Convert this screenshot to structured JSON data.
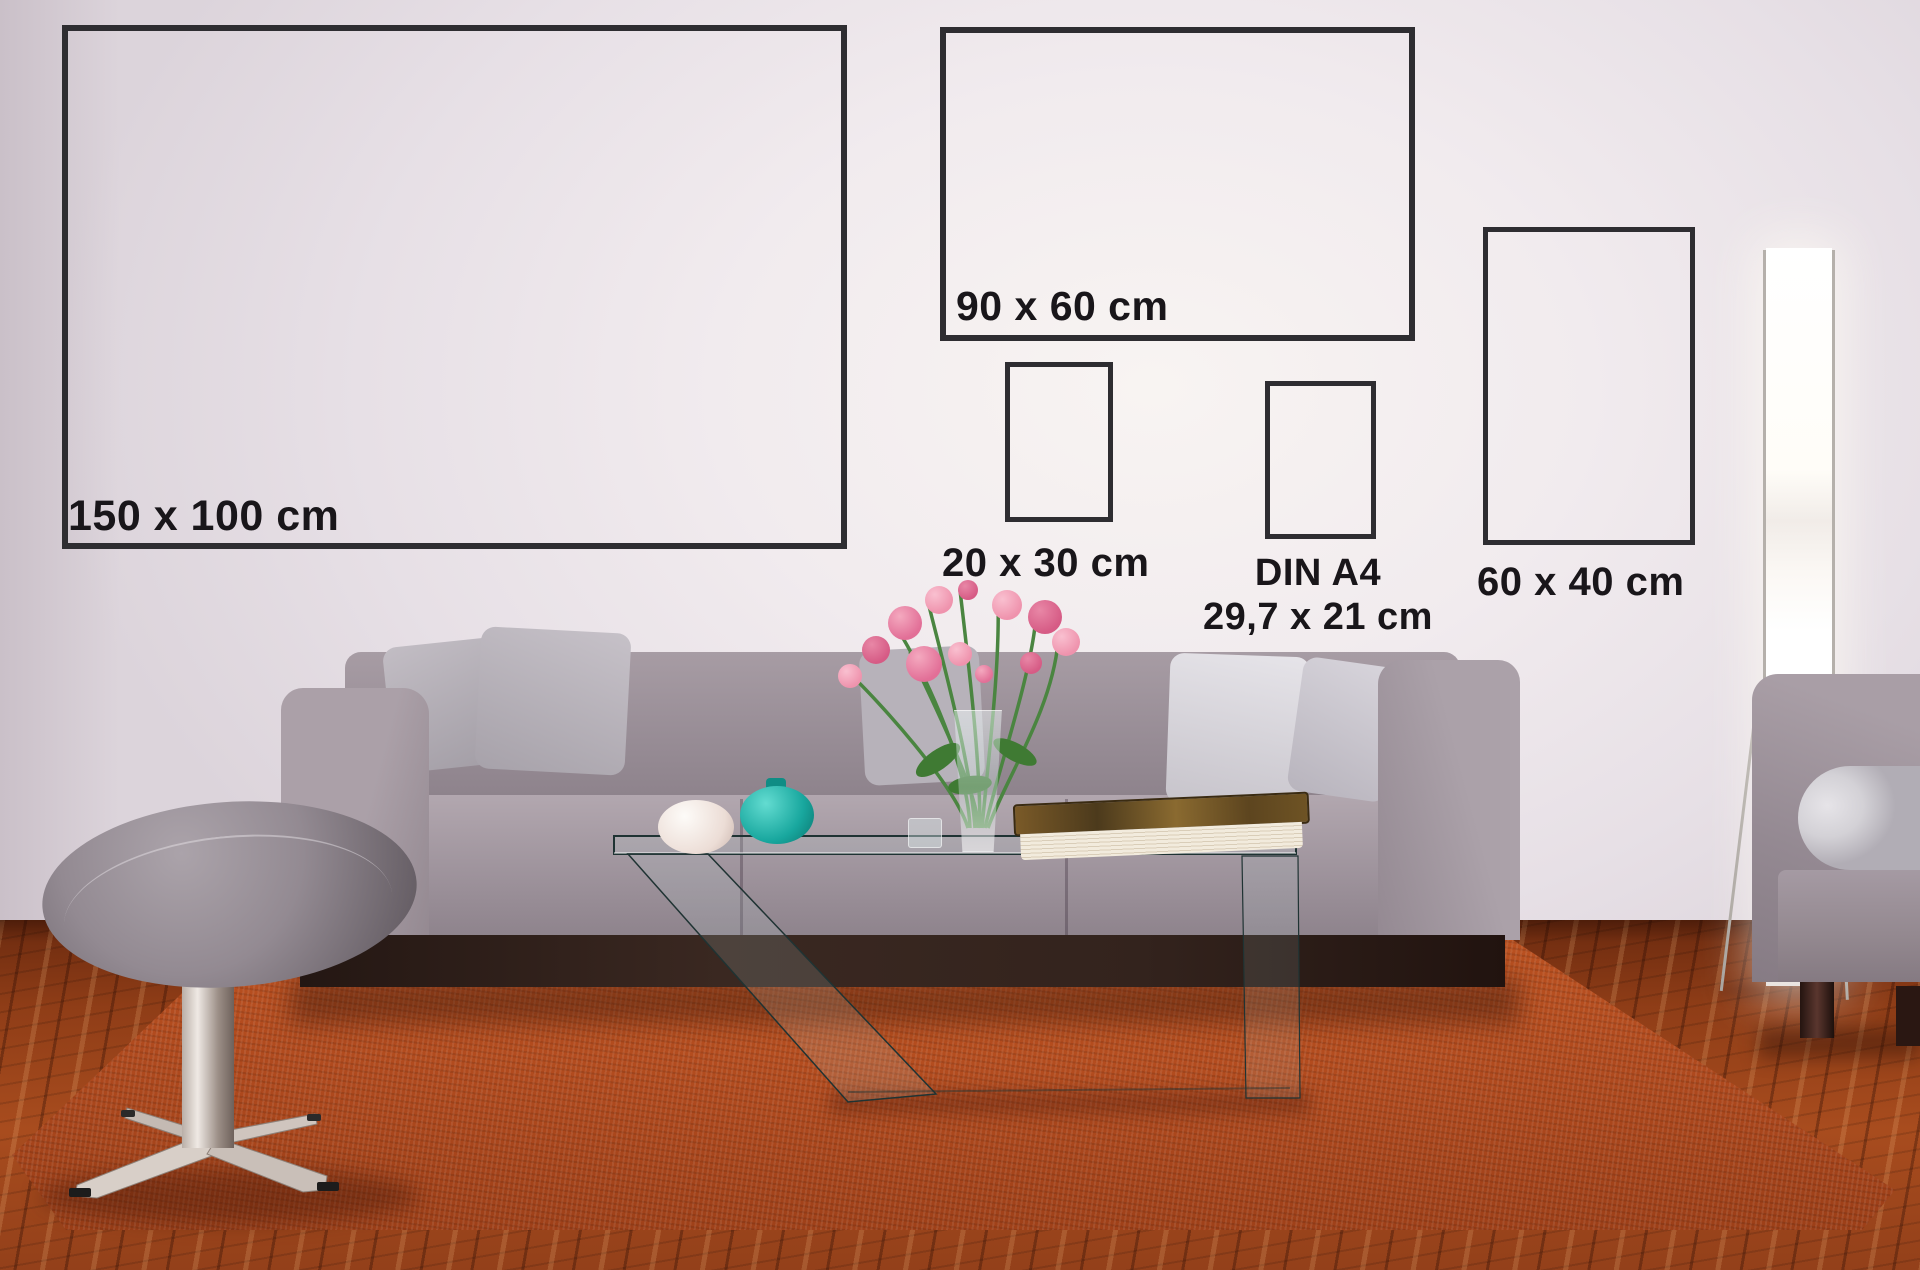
{
  "size_markers": [
    {
      "name": "150x100",
      "label": "150 x 100 cm"
    },
    {
      "name": "90x60",
      "label": "90 x 60 cm"
    },
    {
      "name": "20x30",
      "label": "20 x 30 cm"
    },
    {
      "name": "din-a4",
      "label": "DIN A4",
      "sublabel": "29,7 x 21 cm"
    },
    {
      "name": "60x40",
      "label": "60 x 40 cm"
    }
  ],
  "colors": {
    "wall": "#f1ebee",
    "frame_border": "#2e2d31",
    "label_text": "#19161a",
    "sofa_fabric": "#9a8f98",
    "pillow_light": "#e0dee3",
    "rug_orange": "#b04a1e",
    "wood_floor": "#8f3d17",
    "teal_vase": "#18a79e",
    "white_vase": "#f3eae4",
    "flower_pink": "#e2708f",
    "stool_gray": "#8f868e",
    "lamp_glow": "#ffffff",
    "plinth_wood": "#33231d"
  }
}
